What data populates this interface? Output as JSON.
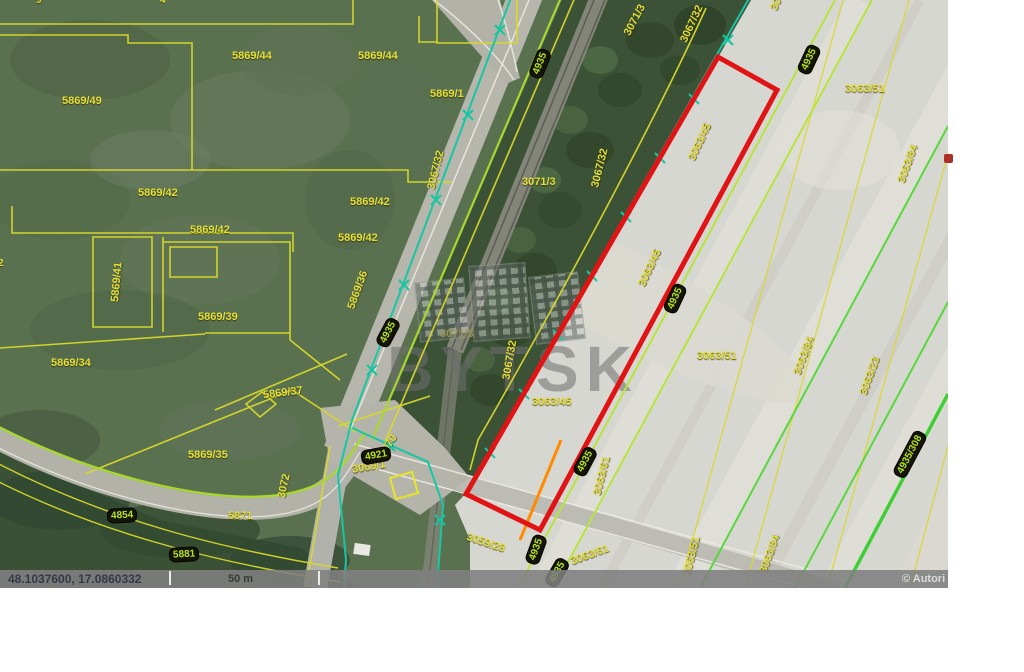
{
  "footer": {
    "coordinates": "48.1037600, 17.0860332",
    "scale_label": "50 m",
    "copyright": "© Autori"
  },
  "watermark": {
    "text": "BYTSK"
  },
  "colors": {
    "highlight_red": "#e01414",
    "parcel_yellow": "#e6df38",
    "road_edge_green": "#a8d830",
    "field_line_green": "#58d83c",
    "utility_teal": "#17c6a2",
    "badge_bg": "#141408",
    "badge_text": "#b6e41c"
  },
  "labels": [
    {
      "text": "5869/44"
    },
    {
      "text": "5869/44"
    },
    {
      "text": "5869/49"
    },
    {
      "text": "5869/1"
    },
    {
      "text": "5869/42"
    },
    {
      "text": "5869/42"
    },
    {
      "text": "5869/42"
    },
    {
      "text": "5869/42"
    },
    {
      "text": "5869/41"
    },
    {
      "text": "5869/39"
    },
    {
      "text": "5869/34"
    },
    {
      "text": "5869/36"
    },
    {
      "text": "5869/37"
    },
    {
      "text": "5869/35"
    },
    {
      "text": "5871"
    },
    {
      "text": "3072"
    },
    {
      "text": "3070"
    },
    {
      "text": "3069/1"
    },
    {
      "text": "3071/3"
    },
    {
      "text": "3067/32"
    },
    {
      "text": "3071/3"
    },
    {
      "text": "3067/32"
    },
    {
      "text": "3067/32"
    },
    {
      "text": "3071/3"
    },
    {
      "text": "3067/32"
    },
    {
      "text": "3063/45"
    },
    {
      "text": "3063/45"
    },
    {
      "text": "3063/45"
    },
    {
      "text": "3063/51"
    },
    {
      "text": "3063/51"
    },
    {
      "text": "3063/84"
    },
    {
      "text": "3063/23"
    },
    {
      "text": "3063/84"
    },
    {
      "text": "3063/51"
    },
    {
      "text": "3063/61"
    },
    {
      "text": "3063/61"
    },
    {
      "text": "3059/28"
    },
    {
      "text": "3063/51"
    },
    {
      "text": "3063/84"
    },
    {
      "text": "9"
    },
    {
      "text": "4"
    },
    {
      "text": "2"
    }
  ],
  "badges": [
    {
      "text": "4854"
    },
    {
      "text": "5881"
    },
    {
      "text": "4921"
    },
    {
      "text": "4935"
    },
    {
      "text": "4935"
    },
    {
      "text": "4935"
    },
    {
      "text": "4935"
    },
    {
      "text": "4935"
    },
    {
      "text": "4935"
    },
    {
      "text": "4935"
    },
    {
      "text": "4935/308"
    }
  ]
}
